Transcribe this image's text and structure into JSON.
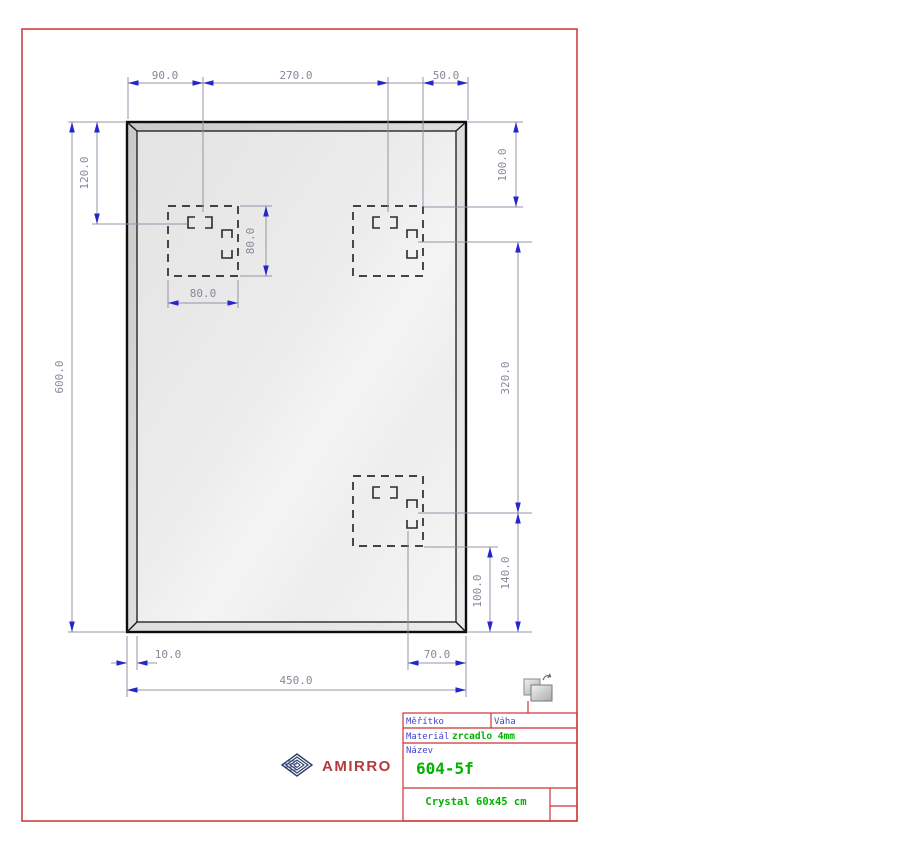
{
  "sheet": {
    "type": "technical-drawing",
    "product": "mirror"
  },
  "dimensions": {
    "top_hole_offset": "90.0",
    "top_hole_spacing": "270.0",
    "top_right_offset": "50.0",
    "height_total": "600.0",
    "top_to_hanger": "120.0",
    "hanger_height": "80.0",
    "hanger_width": "80.0",
    "right_top_offset": "100.0",
    "hole_vertical_spacing": "320.0",
    "bottom_right_offset": "140.0",
    "bottom_hole_offset": "100.0",
    "bevel_width": "10.0",
    "bottom_hole_right": "70.0",
    "width_total": "450.0"
  },
  "title_block": {
    "scale_label": "Měřítko",
    "weight_label": "Váha",
    "material_label": "Materiál",
    "material_value": "zrcadlo 4mm",
    "name_label": "Název",
    "name_value": "604-5f",
    "product_name": "Crystal 60x45 cm"
  },
  "logo": {
    "text": "AMIRRO"
  },
  "icons": {
    "layout_icon": "paper-layout",
    "logo_icon": "nested-diamonds"
  },
  "colors": {
    "frame_red": "#cc3434",
    "dimension_arrow_blue": "#2525cc",
    "dimension_line": "#9394a8",
    "dimension_text": "#87879a",
    "value_green": "#00b300",
    "label_blue": "#4444cc",
    "logo_red": "#b23b40",
    "logo_navy": "#2c3e6b",
    "drawing_black": "#1a1a1a"
  }
}
